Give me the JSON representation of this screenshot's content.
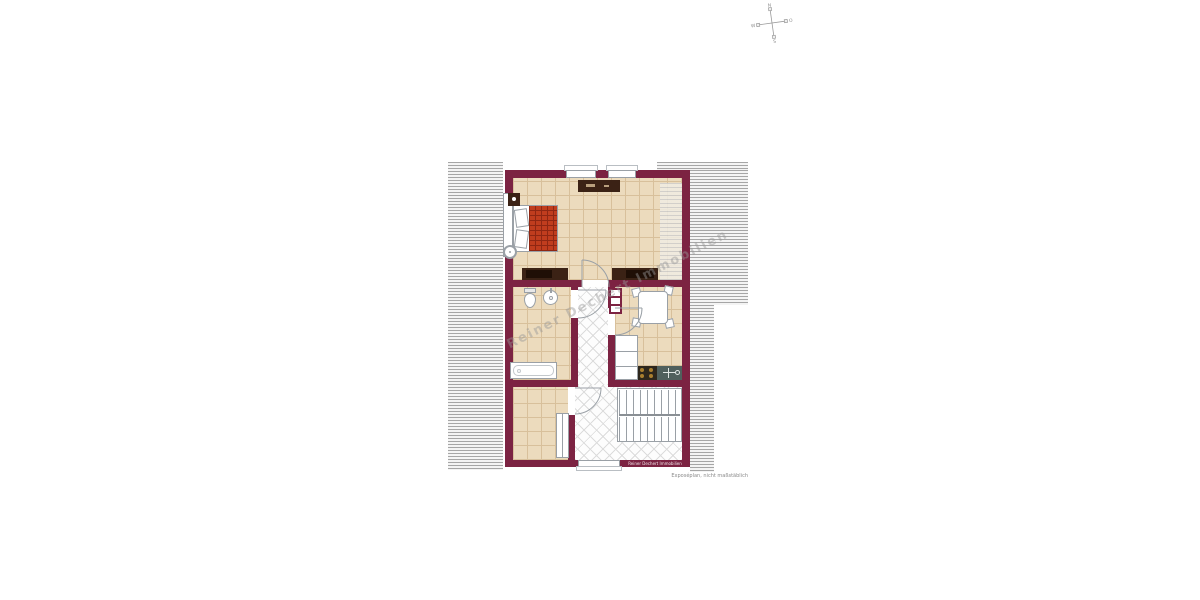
{
  "plan": {
    "watermark_text": "Reiner Dechert Immobilien",
    "brand_band_text": "Reiner Dechert Immobilien",
    "disclaimer_text": "Exposéplan, nicht maßstäblich",
    "colors": {
      "wall": "#7c2342",
      "hatch_line": "#a6a6a6",
      "hatch_bg": "#f4f4f4",
      "tile": "#ecdbbd",
      "tile_line": "#d8c09b",
      "diamond_line": "#dcdcdc",
      "blanket": "#c03d1e",
      "blanket_line": "#8f2713",
      "dark_furniture": "#3b2215",
      "sink_unit": "#50605d",
      "knob": "#a97f2f",
      "stair_line": "#9aa0a6"
    }
  },
  "compass": {
    "n": "N",
    "e": "O",
    "s": "S",
    "w": "W"
  }
}
